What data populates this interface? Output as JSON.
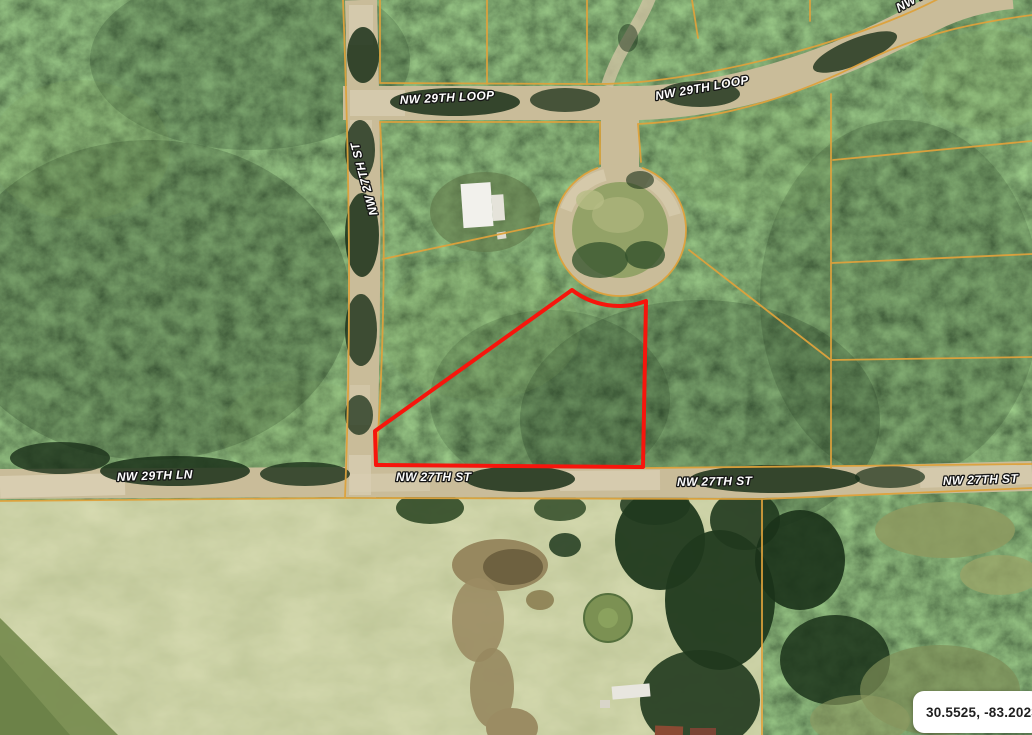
{
  "overlay": {
    "street_labels": [
      {
        "role": "nw-29th-loop-west",
        "text": "NW 29TH LOOP"
      },
      {
        "role": "nw-29th-loop-east",
        "text": "NW 29TH LOOP"
      },
      {
        "role": "nw-29th-loop-top-clipped",
        "text": "NW 29TH LOOP"
      },
      {
        "role": "nw-27th-st-vertical",
        "text": "NW 27TH ST"
      },
      {
        "role": "nw-29th-ln",
        "text": "NW 29TH LN"
      },
      {
        "role": "nw-27th-st-west",
        "text": "NW 27TH ST"
      },
      {
        "role": "nw-27th-st-center",
        "text": "NW 27TH ST"
      },
      {
        "role": "nw-27th-st-east",
        "text": "NW 27TH ST"
      }
    ],
    "coordinate_badge": {
      "text": "30.5525, -83.2023"
    },
    "colors": {
      "parcel_line": "#DEA23C",
      "highlight_outline": "#F7150C",
      "street_label_fill": "#FFFFFF",
      "street_label_outline": "#161616",
      "badge_background": "#FFFFFF",
      "badge_text": "#1F1F1F"
    }
  }
}
